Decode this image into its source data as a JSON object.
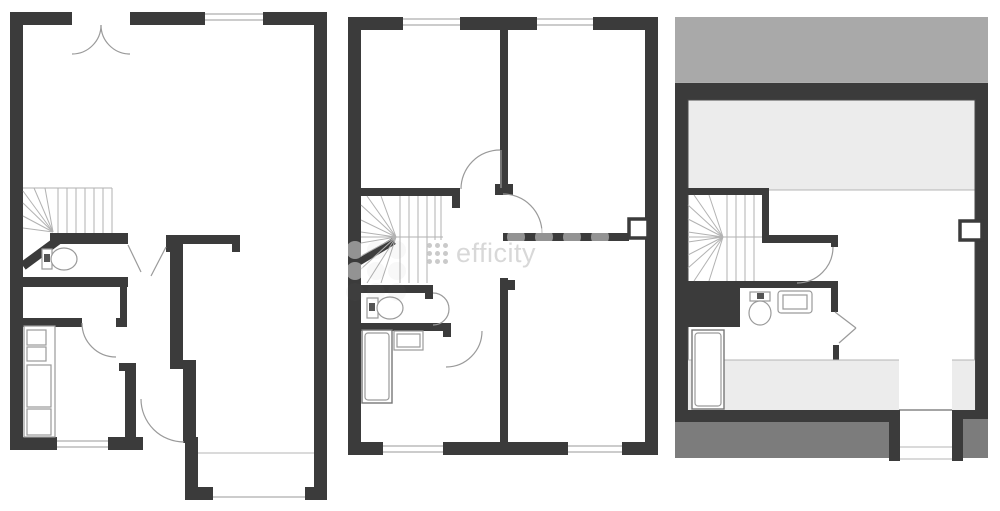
{
  "watermark": {
    "brand": "efficity",
    "logo": "efficity-dots-logo"
  },
  "colors": {
    "background": "#ffffff",
    "wall": "#3b3b3b",
    "roof_light": "#a9a9a9",
    "roof_dark": "#7c7c7c",
    "low_ceiling": "#ececec",
    "line": "#9a9a9a",
    "stair_line": "#b2b2b2",
    "watermark_text": "#d8d8d8",
    "watermark_dot": "#cacaca"
  },
  "plans": [
    {
      "id": "ground-floor",
      "features": [
        "entrance-double-door",
        "living-room",
        "winder-staircase",
        "wc-toilet",
        "kitchen-counter",
        "hallway",
        "rear-annex",
        "windows"
      ]
    },
    {
      "id": "first-floor",
      "features": [
        "bedroom-front-left",
        "bedroom-front-right",
        "winder-staircase",
        "wc-toilet",
        "bedroom-back",
        "bed",
        "side-table",
        "flue",
        "windows"
      ]
    },
    {
      "id": "top-floor",
      "features": [
        "sloped-roof-bands",
        "low-ceiling-zones",
        "winder-staircase",
        "shower-room-toilet-sink",
        "bed",
        "flue",
        "dormer-opening"
      ]
    }
  ]
}
